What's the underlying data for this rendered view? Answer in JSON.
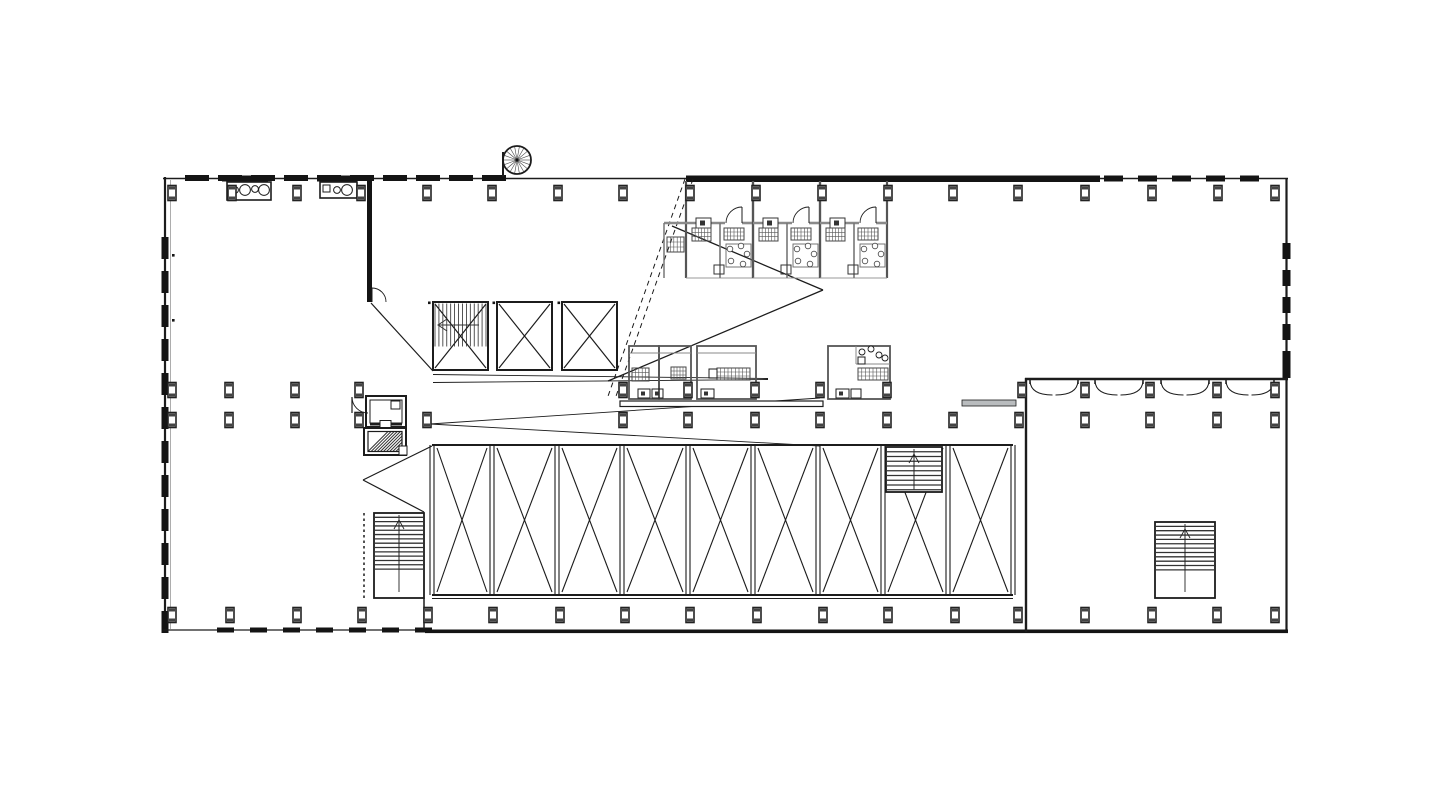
{
  "meta": {
    "kind": "architectural-floor-plan",
    "visible_text": []
  },
  "palette": {
    "ink": "#1c1c1c",
    "dark": "#141414",
    "mid": "#555555",
    "wall_gray": "#8a8a8a",
    "light": "#999999",
    "bench_gray": "#b9bcbe",
    "bg": "#ffffff"
  },
  "canvas": {
    "w": 1440,
    "h": 798
  },
  "plan": {
    "shapes": [
      {
        "t": "line",
        "n": "wall-left",
        "x1": 165,
        "y1": 177,
        "x2": 165,
        "y2": 632,
        "w": 2.2
      },
      {
        "t": "line",
        "n": "wall-left-inner",
        "x1": 170.5,
        "y1": 180,
        "x2": 170.5,
        "y2": 629,
        "w": 0.8,
        "c": "#999999"
      },
      {
        "t": "bcol",
        "n": "left-mullions",
        "x": 161.5,
        "y": 237,
        "step": 34,
        "count": 12,
        "bw": 7,
        "bh": 22
      },
      {
        "t": "line",
        "n": "wall-top",
        "x1": 163,
        "y1": 178.5,
        "x2": 1288,
        "y2": 178.5,
        "w": 1.6
      },
      {
        "t": "brow",
        "n": "top-mullions-west",
        "x": 185,
        "y": 175,
        "step": 33,
        "count": 10,
        "bw": 24,
        "bh": 6
      },
      {
        "t": "rect",
        "n": "wall-top-solid",
        "x": 686,
        "y": 175.5,
        "w": 414,
        "h": 6.5,
        "f": "#141414"
      },
      {
        "t": "brow",
        "n": "top-mullions-east",
        "x": 1104,
        "y": 175.5,
        "step": 34,
        "count": 5,
        "bw": 19,
        "bh": 6
      },
      {
        "t": "line",
        "n": "wall-right",
        "x1": 1286.5,
        "y1": 178,
        "x2": 1286.5,
        "y2": 632,
        "w": 2.2
      },
      {
        "t": "bcol",
        "n": "right-mullions",
        "x": 1282.5,
        "y": 243,
        "step": 27,
        "count": 5,
        "bw": 8,
        "bh": 16
      },
      {
        "t": "rect",
        "n": "right-corner-block",
        "x": 1282.5,
        "y": 367,
        "w": 8,
        "h": 11,
        "f": "#141414"
      },
      {
        "t": "line",
        "n": "wall-bottom-west",
        "x1": 163,
        "y1": 630,
        "x2": 430,
        "y2": 630,
        "w": 1.3
      },
      {
        "t": "brow",
        "n": "bottom-mullions",
        "x": 217,
        "y": 627.5,
        "step": 33,
        "count": 7,
        "bw": 17,
        "bh": 5
      },
      {
        "t": "rect",
        "n": "wall-bottom-east",
        "x": 425,
        "y": 629.5,
        "w": 863,
        "h": 3.6,
        "f": "#141414"
      },
      {
        "t": "rect",
        "n": "core-wall",
        "x": 367,
        "y": 178,
        "w": 5,
        "h": 124,
        "f": "#141414"
      },
      {
        "t": "line",
        "x1": 372,
        "y1": 288,
        "x2": 372,
        "y2": 302,
        "w": 1
      },
      {
        "t": "path",
        "n": "door-arc-core",
        "d": "M 372 288 A 14 14 0 0 1 386 302",
        "w": 0.9
      },
      {
        "t": "spiral",
        "n": "spiral-stair",
        "cx": 517,
        "cy": 160,
        "r": 14,
        "spokes": 18
      },
      {
        "t": "line",
        "x1": 503,
        "y1": 152,
        "x2": 503,
        "y2": 177,
        "w": 2
      },
      {
        "t": "rect",
        "n": "counter-1",
        "x": 222,
        "y": 175.5,
        "w": 46,
        "h": 6,
        "f": "#141414"
      },
      {
        "t": "rect",
        "n": "sink-unit-1",
        "x": 227,
        "y": 182,
        "w": 44,
        "h": 18,
        "sw": 1.6
      },
      {
        "t": "circle",
        "n": "sink-bowl",
        "cx": 235,
        "cy": 190,
        "r": 3.4,
        "sw": 1
      },
      {
        "t": "circle",
        "n": "sink-bowl",
        "cx": 245,
        "cy": 190,
        "r": 5.4,
        "sw": 1
      },
      {
        "t": "circle",
        "n": "sink-bowl",
        "cx": 255,
        "cy": 189,
        "r": 3.4,
        "sw": 1
      },
      {
        "t": "circle",
        "n": "sink-bowl",
        "cx": 264,
        "cy": 190,
        "r": 5.4,
        "sw": 1
      },
      {
        "t": "rect",
        "n": "counter-2",
        "x": 317,
        "y": 175.5,
        "w": 40,
        "h": 6,
        "f": "#141414"
      },
      {
        "t": "rect",
        "n": "sink-unit-2",
        "x": 320,
        "y": 182,
        "w": 37,
        "h": 16,
        "sw": 1.6
      },
      {
        "t": "rect",
        "x": 323,
        "y": 185,
        "w": 7,
        "h": 7,
        "sw": 1
      },
      {
        "t": "circle",
        "n": "sink-bowl",
        "cx": 337,
        "cy": 190,
        "r": 3.4,
        "sw": 1
      },
      {
        "t": "circle",
        "n": "sink-bowl",
        "cx": 347,
        "cy": 190,
        "r": 5.4,
        "sw": 1
      },
      {
        "t": "xbox",
        "n": "shaft-stair-core",
        "x": 433,
        "y": 302,
        "w": 55,
        "h": 68,
        "sw": 2
      },
      {
        "t": "hatch",
        "x": 435,
        "y": 303.5,
        "w": 51,
        "h": 43,
        "n": 14,
        "dir": "v",
        "c": "#2a2a2a",
        "sw": 0.8
      },
      {
        "t": "line",
        "x1": 438,
        "y1": 325,
        "x2": 479,
        "y2": 325,
        "w": 1,
        "c": "#333333"
      },
      {
        "t": "vee",
        "n": "stair-arrow-west",
        "pts": [
          [
            447,
            319
          ],
          [
            438,
            325
          ],
          [
            447,
            331
          ]
        ],
        "w": 1,
        "c": "#333333"
      },
      {
        "t": "xbox",
        "n": "shaft-2",
        "x": 497,
        "y": 302,
        "w": 55,
        "h": 68,
        "sw": 2
      },
      {
        "t": "xbox",
        "n": "shaft-3",
        "x": 562,
        "y": 302,
        "w": 55,
        "h": 68,
        "sw": 2
      },
      {
        "t": "rect",
        "x": 428,
        "y": 301.5,
        "w": 2.6,
        "h": 2.6,
        "f": "#141414"
      },
      {
        "t": "rect",
        "x": 492.5,
        "y": 301.5,
        "w": 2.6,
        "h": 2.6,
        "f": "#141414"
      },
      {
        "t": "rect",
        "x": 557.5,
        "y": 301.5,
        "w": 2.6,
        "h": 2.6,
        "f": "#141414"
      },
      {
        "t": "rect",
        "x": 172,
        "y": 254,
        "w": 2.6,
        "h": 2.6,
        "f": "#141414"
      },
      {
        "t": "rect",
        "x": 172,
        "y": 319,
        "w": 2.6,
        "h": 2.6,
        "f": "#141414"
      },
      {
        "t": "line",
        "n": "sight-line",
        "x1": 371,
        "y1": 303,
        "x2": 433,
        "y2": 371,
        "w": 1.2
      },
      {
        "t": "line",
        "n": "sight-line",
        "x1": 433,
        "y1": 374.5,
        "x2": 768,
        "y2": 378.5,
        "w": 0.9
      },
      {
        "t": "line",
        "n": "sight-line",
        "x1": 433,
        "y1": 382.5,
        "x2": 768,
        "y2": 379.5,
        "w": 0.9
      },
      {
        "t": "line",
        "n": "sight-line",
        "x1": 430,
        "y1": 424,
        "x2": 820,
        "y2": 398,
        "w": 0.9
      },
      {
        "t": "line",
        "n": "sight-line",
        "x1": 430,
        "y1": 424,
        "x2": 820,
        "y2": 446,
        "w": 0.9
      },
      {
        "t": "line",
        "n": "sight-line",
        "x1": 672,
        "y1": 226,
        "x2": 823,
        "y2": 290,
        "w": 1.3
      },
      {
        "t": "line",
        "n": "sight-line",
        "x1": 823,
        "y1": 290,
        "x2": 608,
        "y2": 381,
        "w": 1.3
      },
      {
        "t": "line",
        "n": "section-line-dashed",
        "x1": 685,
        "y1": 179,
        "x2": 607,
        "y2": 399,
        "w": 1,
        "dash": "5,4"
      },
      {
        "t": "line",
        "n": "section-line-dashed",
        "x1": 693,
        "y1": 179,
        "x2": 615,
        "y2": 399,
        "w": 1,
        "dash": "5,4"
      },
      {
        "t": "line",
        "n": "sight-line",
        "x1": 432,
        "y1": 446,
        "x2": 363,
        "y2": 480,
        "w": 1.2
      },
      {
        "t": "line",
        "n": "sight-line",
        "x1": 363,
        "y1": 480,
        "x2": 424,
        "y2": 512,
        "w": 1.2
      },
      {
        "t": "rect",
        "n": "elevator-1",
        "x": 366,
        "y": 396,
        "w": 40,
        "h": 31,
        "sw": 2
      },
      {
        "t": "rect",
        "x": 370,
        "y": 400,
        "w": 32,
        "h": 23,
        "sw": 1
      },
      {
        "t": "rect",
        "x": 391,
        "y": 401,
        "w": 9,
        "h": 8,
        "sw": 1
      },
      {
        "t": "line",
        "x1": 370,
        "y1": 424.5,
        "x2": 402,
        "y2": 424.5,
        "w": 2
      },
      {
        "t": "rect",
        "x": 380,
        "y": 420.5,
        "w": 11,
        "h": 7,
        "sw": 1,
        "f": "#ffffff"
      },
      {
        "t": "line",
        "x1": 352,
        "y1": 397,
        "x2": 352,
        "y2": 413,
        "w": 1.2
      },
      {
        "t": "path",
        "n": "door-arc-elevator",
        "d": "M 352 397 A 16 16 0 0 0 368 413",
        "w": 0.9
      },
      {
        "t": "rect",
        "n": "elevator-2",
        "x": 364,
        "y": 428,
        "w": 42,
        "h": 27,
        "sw": 2
      },
      {
        "t": "hatch",
        "x": 368,
        "y": 431.5,
        "w": 34,
        "h": 20,
        "n": 12,
        "dir": "d",
        "c": "#333333",
        "sw": 1
      },
      {
        "t": "rect",
        "x": 368,
        "y": 431.5,
        "w": 34,
        "h": 20,
        "sw": 1.2
      },
      {
        "t": "rect",
        "x": 399,
        "y": 446,
        "w": 8,
        "h": 9,
        "sw": 1,
        "f": "#ffffff"
      },
      {
        "t": "line",
        "n": "stair-rail-dashed",
        "x1": 364,
        "y1": 513,
        "x2": 364,
        "y2": 598,
        "w": 1.5,
        "dash": "2.5,3"
      },
      {
        "t": "stair",
        "n": 13,
        "x": 374,
        "y": 513,
        "w": 50,
        "h": 85,
        "frac": 0.66,
        "arrow": true
      },
      {
        "t": "line",
        "x1": 424,
        "y1": 598,
        "x2": 424,
        "y2": 629,
        "w": 1.5
      },
      {
        "t": "bays",
        "n": "braced-bays",
        "edges": [
          432,
          492,
          557,
          622,
          688,
          753,
          818,
          883,
          948,
          1013
        ],
        "y1": 445,
        "y2": 595
      },
      {
        "t": "stair",
        "n": 9,
        "x": 886,
        "y": 447,
        "w": 56,
        "h": 45,
        "frac": 0.95,
        "arrow": true
      },
      {
        "t": "line",
        "n": "wing-wall-west",
        "x1": 1026,
        "y1": 378,
        "x2": 1026,
        "y2": 632,
        "w": 2.4
      },
      {
        "t": "line",
        "n": "wing-wall-north",
        "x1": 1025,
        "y1": 379,
        "x2": 1288,
        "y2": 379,
        "w": 2.4
      },
      {
        "t": "ddoor",
        "n": "double-door",
        "cx": 1054
      },
      {
        "t": "ddoor",
        "n": "double-door",
        "cx": 1119
      },
      {
        "t": "ddoor",
        "n": "double-door",
        "cx": 1185
      },
      {
        "t": "ddoor",
        "n": "double-door",
        "cx": 1250
      },
      {
        "t": "rect",
        "n": "bench",
        "x": 962,
        "y": 400,
        "w": 54,
        "h": 6,
        "f": "#b9bcbe",
        "sw": 0.8
      },
      {
        "t": "stair",
        "n": 11,
        "x": 1155,
        "y": 522,
        "w": 60,
        "h": 76,
        "frac": 0.63,
        "arrow": true
      },
      {
        "t": "rect",
        "n": "counter-mid",
        "x": 620,
        "y": 401,
        "w": 203,
        "h": 5.5,
        "sw": 1.2,
        "f": "#ffffff"
      },
      {
        "t": "room",
        "n": "hotel-room-1",
        "x": 686
      },
      {
        "t": "room",
        "n": "hotel-room-2",
        "x": 753
      },
      {
        "t": "room",
        "n": "hotel-room-3",
        "x": 820
      },
      {
        "t": "line",
        "x1": 664,
        "y1": 223,
        "x2": 686,
        "y2": 223,
        "w": 2.4,
        "c": "#8a8a8a"
      },
      {
        "t": "line",
        "x1": 664,
        "y1": 223,
        "x2": 664,
        "y2": 278,
        "w": 1.5,
        "c": "#777777"
      },
      {
        "t": "grid",
        "x": 667,
        "y": 237,
        "w": 17,
        "h": 15,
        "nv": 4,
        "nh": 2
      },
      {
        "t": "rect",
        "n": "meeting-room-a1",
        "x": 629,
        "y": 346,
        "w": 30,
        "h": 53,
        "sw": 1.8,
        "c": "#555555"
      },
      {
        "t": "rect",
        "n": "meeting-room-a2",
        "x": 659,
        "y": 346,
        "w": 32,
        "h": 53,
        "sw": 1.8,
        "c": "#555555"
      },
      {
        "t": "line",
        "x1": 629,
        "y1": 353,
        "x2": 691,
        "y2": 353,
        "w": 1,
        "c": "#888888"
      },
      {
        "t": "grid",
        "x": 632,
        "y": 368,
        "w": 17,
        "h": 13,
        "nv": 4,
        "nh": 2
      },
      {
        "t": "grid",
        "x": 671,
        "y": 367,
        "w": 15,
        "h": 12,
        "nv": 4,
        "nh": 2
      },
      {
        "t": "rect",
        "x": 638,
        "y": 389,
        "w": 12,
        "h": 9,
        "sw": 1
      },
      {
        "t": "rect",
        "x": 652,
        "y": 389,
        "w": 11,
        "h": 9,
        "sw": 1
      },
      {
        "t": "rect",
        "x": 641,
        "y": 391.5,
        "w": 4,
        "h": 4,
        "f": "#333333"
      },
      {
        "t": "rect",
        "x": 655,
        "y": 391.5,
        "w": 4,
        "h": 4,
        "f": "#333333"
      },
      {
        "t": "rect",
        "n": "meeting-room-b",
        "x": 697,
        "y": 346,
        "w": 59,
        "h": 53,
        "sw": 1.8,
        "c": "#555555"
      },
      {
        "t": "line",
        "x1": 697,
        "y1": 353,
        "x2": 756,
        "y2": 353,
        "w": 1,
        "c": "#888888"
      },
      {
        "t": "grid",
        "x": 717,
        "y": 368,
        "w": 33,
        "h": 12,
        "nv": 8,
        "nh": 2
      },
      {
        "t": "rect",
        "x": 709,
        "y": 369,
        "w": 8,
        "h": 9,
        "sw": 1
      },
      {
        "t": "rect",
        "x": 701,
        "y": 389,
        "w": 13,
        "h": 9,
        "sw": 1
      },
      {
        "t": "rect",
        "x": 704,
        "y": 391.5,
        "w": 4,
        "h": 4,
        "f": "#333333"
      },
      {
        "t": "rect",
        "n": "meeting-room-c",
        "x": 828,
        "y": 346,
        "w": 62,
        "h": 53,
        "sw": 1.8,
        "c": "#555555"
      },
      {
        "t": "line",
        "x1": 856,
        "y1": 346,
        "x2": 856,
        "y2": 364,
        "w": 1,
        "c": "#888888"
      },
      {
        "t": "line",
        "x1": 856,
        "y1": 364,
        "x2": 890,
        "y2": 364,
        "w": 1,
        "c": "#888888"
      },
      {
        "t": "circle",
        "n": "chair",
        "cx": 862,
        "cy": 352,
        "r": 3,
        "sw": 0.9
      },
      {
        "t": "circle",
        "n": "chair",
        "cx": 871,
        "cy": 349,
        "r": 3,
        "sw": 0.9
      },
      {
        "t": "circle",
        "n": "chair",
        "cx": 879,
        "cy": 355,
        "r": 3,
        "sw": 0.9
      },
      {
        "t": "circle",
        "n": "chair",
        "cx": 885,
        "cy": 358,
        "r": 3,
        "sw": 0.9
      },
      {
        "t": "rect",
        "x": 858,
        "y": 357,
        "w": 7,
        "h": 7,
        "sw": 1
      },
      {
        "t": "grid",
        "x": 858,
        "y": 368,
        "w": 30,
        "h": 12,
        "nv": 7,
        "nh": 2
      },
      {
        "t": "rect",
        "x": 836,
        "y": 389,
        "w": 13,
        "h": 9,
        "sw": 1
      },
      {
        "t": "rect",
        "x": 851,
        "y": 389,
        "w": 10,
        "h": 9,
        "sw": 1
      },
      {
        "t": "rect",
        "x": 839,
        "y": 391.5,
        "w": 4,
        "h": 4,
        "f": "#333333"
      },
      {
        "t": "cols",
        "n": "columns-north",
        "y": 193,
        "xs": [
          172,
          232,
          297,
          361,
          427,
          492,
          558,
          623,
          690,
          756,
          822,
          888,
          953,
          1018,
          1085,
          1152,
          1218,
          1275
        ]
      },
      {
        "t": "cols",
        "n": "columns-mid-upper",
        "y": 390,
        "xs": [
          172,
          229,
          295,
          359,
          623,
          688,
          755,
          820,
          887,
          1022,
          1085,
          1150,
          1217,
          1275
        ]
      },
      {
        "t": "cols",
        "n": "columns-mid-lower",
        "y": 420,
        "xs": [
          172,
          229,
          295,
          359,
          427,
          623,
          688,
          755,
          820,
          887,
          953,
          1019,
          1085,
          1150,
          1217,
          1275
        ]
      },
      {
        "t": "cols",
        "n": "columns-south",
        "y": 615,
        "xs": [
          172,
          230,
          297,
          362,
          428,
          493,
          560,
          625,
          690,
          757,
          823,
          888,
          955,
          1018,
          1085,
          1152,
          1217,
          1275
        ]
      }
    ]
  }
}
